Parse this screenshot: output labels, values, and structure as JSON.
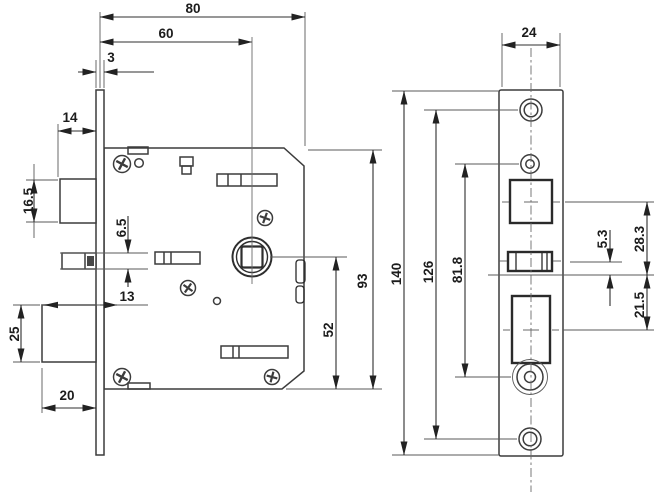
{
  "drawing": {
    "kind": "mortise-lock-technical-drawing",
    "line_color": "#3c3c3c",
    "background": "#ffffff",
    "dims": {
      "d80": "80",
      "d60": "60",
      "d3": "3",
      "d14": "14",
      "d16_5": "16.5",
      "d6_5": "6.5",
      "d13": "13",
      "d25": "25",
      "d20": "20",
      "d52": "52",
      "d93": "93",
      "d24": "24",
      "d140": "140",
      "d126": "126",
      "d81_8": "81.8",
      "d5_3": "5.3",
      "d28_3": "28.3",
      "d21_5": "21.5"
    }
  }
}
